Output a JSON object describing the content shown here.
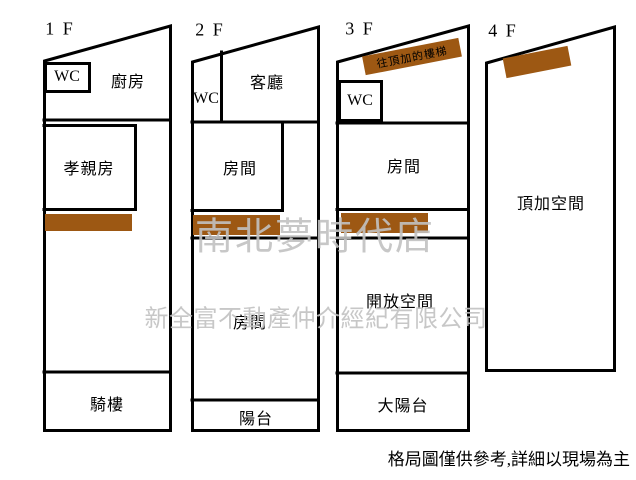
{
  "floors": [
    {
      "label": "1 F",
      "rooms": {
        "wc": "WC",
        "kitchen": "廚房",
        "parents_room": "孝親房",
        "arcade": "騎樓"
      }
    },
    {
      "label": "2 F",
      "rooms": {
        "wc": "WC",
        "living_room": "客廳",
        "room_upper": "房間",
        "room_lower": "房間",
        "balcony": "陽台"
      }
    },
    {
      "label": "3 F",
      "rooms": {
        "wc": "WC",
        "room": "房間",
        "open_space": "開放空間",
        "big_balcony": "大陽台"
      },
      "stair_note": "往頂加的樓梯"
    },
    {
      "label": "4 F",
      "rooms": {
        "rooftop_space": "頂加空間"
      }
    }
  ],
  "watermarks": {
    "store_name": "南北夢時代店",
    "company_name": "新全富不動產仲介經紀有限公司"
  },
  "disclaimer": "格局圖僅供參考,詳細以現場為主",
  "colors": {
    "stair_brown": "#9d5813",
    "watermark_grey": "#c2c2c2",
    "wall_black": "#000000"
  }
}
